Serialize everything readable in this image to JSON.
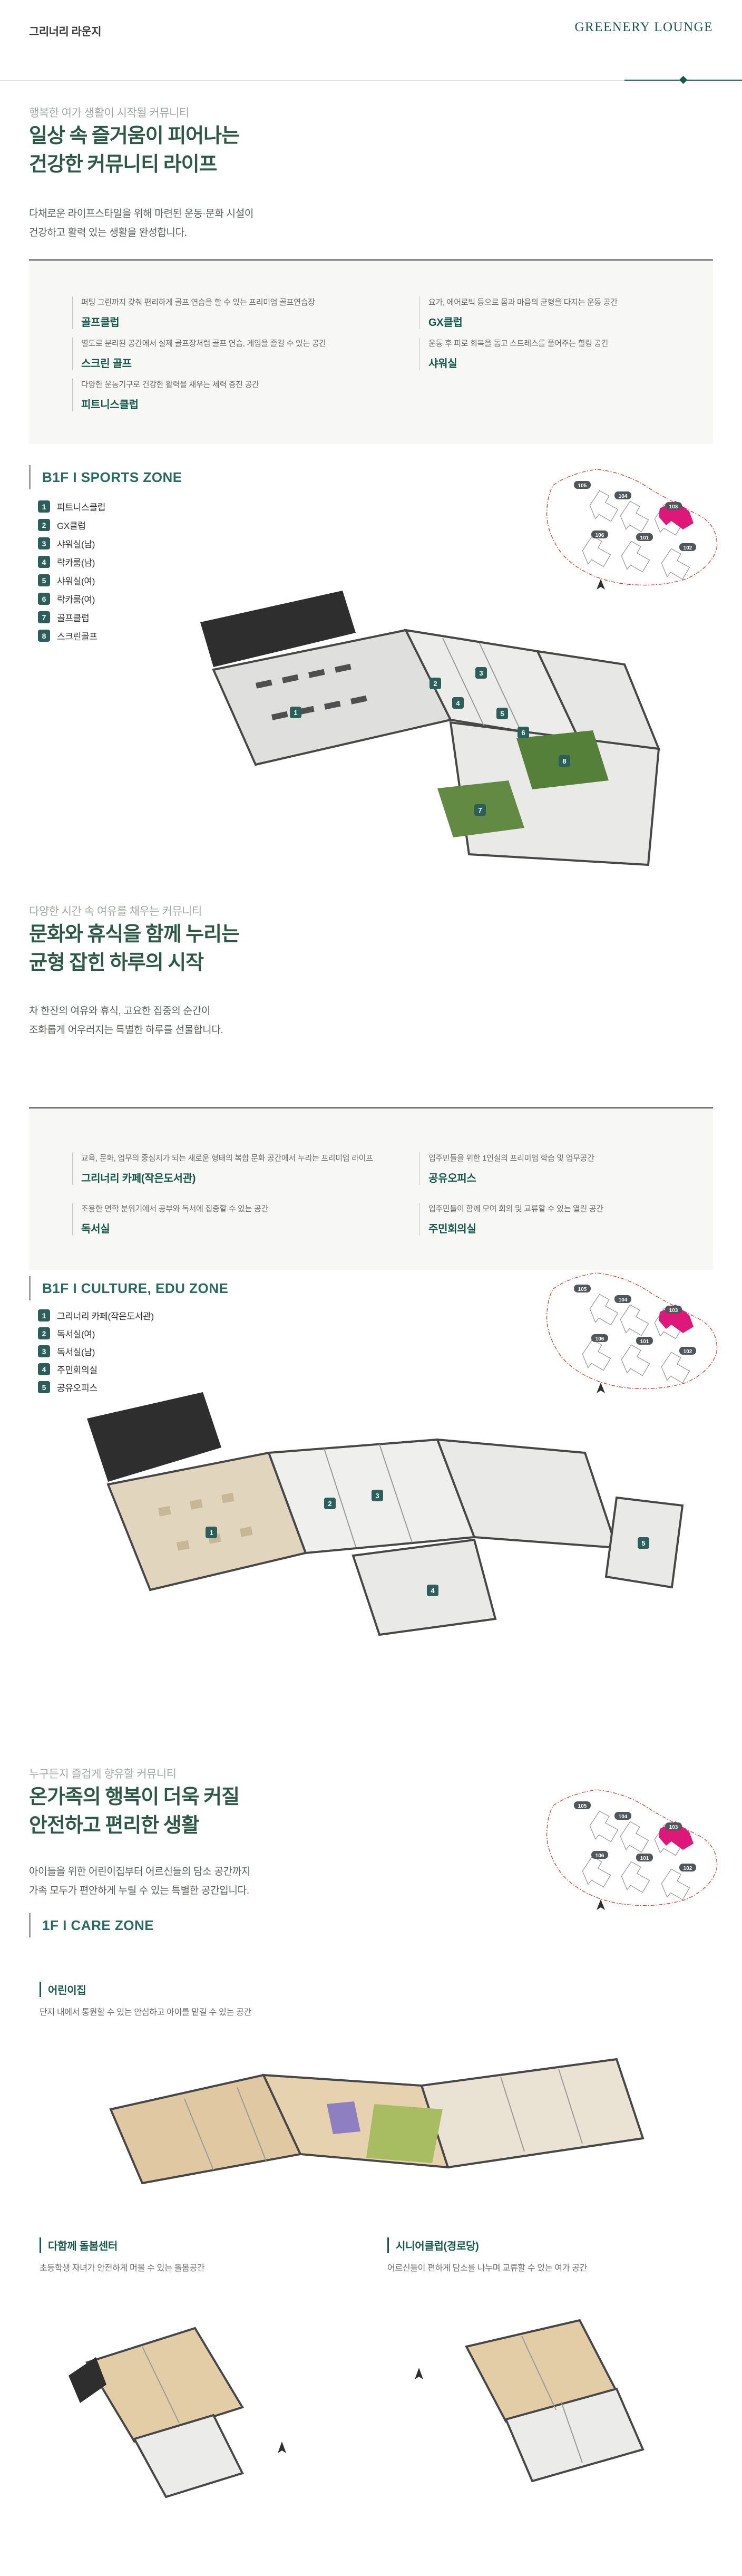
{
  "header": {
    "title_ko": "그리너리 라운지",
    "title_en": "GREENERY LOUNGE"
  },
  "sections": [
    {
      "eyebrow": "행복한 여가 생활이 시작될 커뮤니티",
      "title_line1": "일상 속 즐거움이 피어나는",
      "title_line2": "건강한 커뮤니티 라이프",
      "desc_line1": "다채로운 라이프스타일을 위해 마련된 운동·문화 시설이",
      "desc_line2": "건강하고 활력 있는 생활을 완성합니다.",
      "zone_label": "B1F  I  SPORTS ZONE",
      "facilities_left": [
        {
          "desc": "퍼팅 그린까지 갖춰 편리하게 골프 연습을 할 수 있는 프리미엄 골프연습장",
          "title": "골프클럽"
        },
        {
          "desc": "별도로 분리된 공간에서 실제 골프장처럼 골프 연습, 게임을 즐길 수 있는 공간",
          "title": "스크린 골프"
        },
        {
          "desc": "다양한 운동기구로 건강한 활력을 채우는 체력 증진 공간",
          "title": "피트니스클럽"
        }
      ],
      "facilities_right": [
        {
          "desc": "요가, 에어로빅 등으로 몸과 마음의 균형을 다지는 운동 공간",
          "title": "GX클럽"
        },
        {
          "desc": "운동 후 피로 회복을 돕고 스트레스를 풀어주는 힐링 공간",
          "title": "샤워실"
        }
      ],
      "legend": [
        {
          "n": "1",
          "label": "피트니스클럽"
        },
        {
          "n": "2",
          "label": "GX클럽"
        },
        {
          "n": "3",
          "label": "샤워실(남)"
        },
        {
          "n": "4",
          "label": "락카룸(남)"
        },
        {
          "n": "5",
          "label": "샤워실(여)"
        },
        {
          "n": "6",
          "label": "락카룸(여)"
        },
        {
          "n": "7",
          "label": "골프클럽"
        },
        {
          "n": "8",
          "label": "스크린골프"
        }
      ]
    },
    {
      "eyebrow": "다양한 시간 속 여유를 채우는 커뮤니티",
      "title_line1": "문화와 휴식을 함께 누리는",
      "title_line2": "균형 잡힌 하루의 시작",
      "desc_line1": "차 한잔의 여유와 휴식, 고요한 집중의 순간이",
      "desc_line2": "조화롭게 어우러지는 특별한 하루를 선물합니다.",
      "zone_label": "B1F  I  CULTURE, EDU ZONE",
      "facilities_left": [
        {
          "desc": "교육, 문화, 업무의 중심지가 되는 새로운 형태의 복합 문화 공간에서 누리는 프리미엄 라이프",
          "title": "그리너리 카페(작은도서관)"
        },
        {
          "desc": "조용한 면학 분위기에서 공부와 독서에 집중할 수 있는 공간",
          "title": "독서실"
        }
      ],
      "facilities_right": [
        {
          "desc": "입주민들을 위한 1인실의 프리미엄 학습 및 업무공간",
          "title": "공유오피스"
        },
        {
          "desc": "입주민들이 함께 모여 회의 및 교류할 수 있는 열린 공간",
          "title": "주민회의실"
        }
      ],
      "legend": [
        {
          "n": "1",
          "label": "그리너리 카페(작은도서관)"
        },
        {
          "n": "2",
          "label": "독서실(여)"
        },
        {
          "n": "3",
          "label": "독서실(남)"
        },
        {
          "n": "4",
          "label": "주민회의실"
        },
        {
          "n": "5",
          "label": "공유오피스"
        }
      ]
    },
    {
      "eyebrow": "누구든지 즐겁게 향유할 커뮤니티",
      "title_line1": "온가족의 행복이 더욱 커질",
      "title_line2": "안전하고 편리한 생활",
      "desc_line1": "아이들을 위한 어린이집부터 어르신들의 담소 공간까지",
      "desc_line2": "가족 모두가 편안하게 누릴 수 있는 특별한 공간입니다.",
      "zone_label": "1F  I  CARE ZONE"
    }
  ],
  "site_map": {
    "buildings": [
      "105",
      "104",
      "103",
      "106",
      "101",
      "102"
    ],
    "highlight": "103",
    "boundary_color": "#c94a35",
    "highlight_color": "#de1879"
  },
  "care": {
    "subsection_title": "어린이집",
    "subsection_desc": "단지 내에서 통원할 수 있는 안심하고 아이를 맡길 수 있는 공간",
    "cards": [
      {
        "title": "다함께 돌봄센터",
        "desc": "초등학생 자녀가 안전하게 머물 수 있는 돌봄공간"
      },
      {
        "title": "시니어클럽(경로당)",
        "desc": "어르신들이 편하게 담소를 나누며 교류할 수 있는 여가 공간"
      }
    ]
  },
  "plans": {
    "sports_badges": [
      "1",
      "2",
      "3",
      "4",
      "5",
      "6",
      "7",
      "8"
    ],
    "culture_badges": [
      "1",
      "2",
      "3",
      "4",
      "5"
    ]
  },
  "colors": {
    "accent_green": "#2b5847",
    "zone_teal": "#266a60",
    "badge_teal": "#2d5f5a",
    "panel_gray": "#f7f7f6"
  }
}
